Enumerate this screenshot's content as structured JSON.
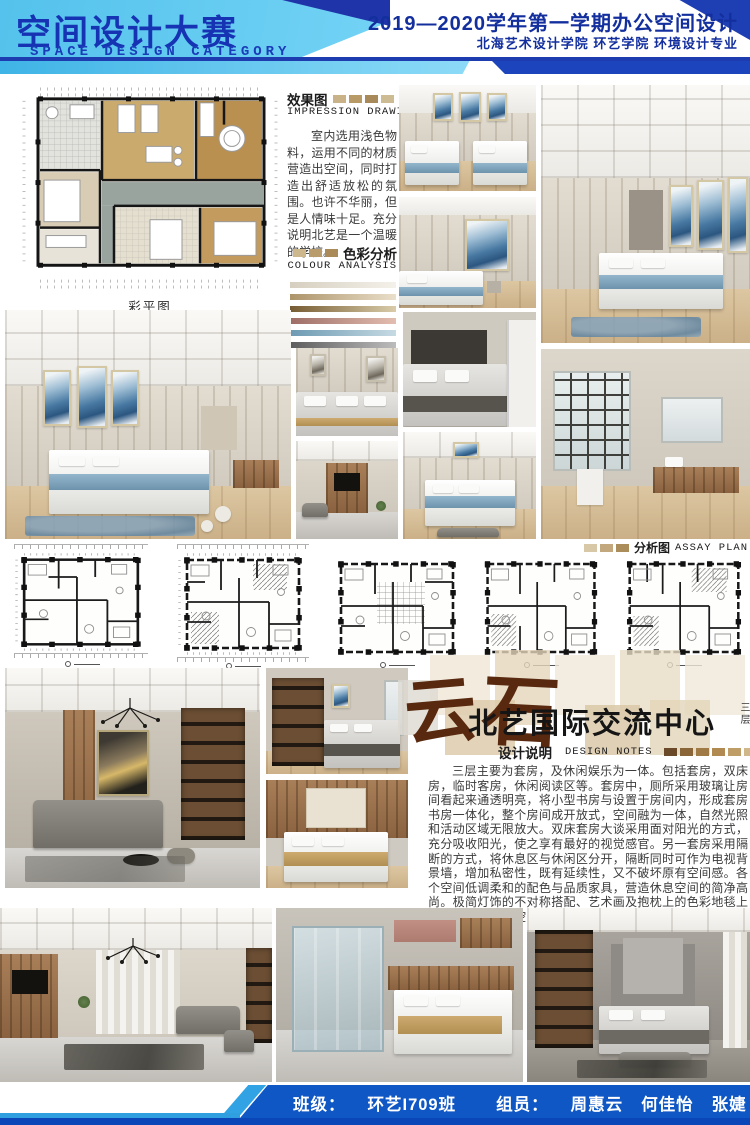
{
  "header": {
    "title_cn": "空间设计大赛",
    "title_en": "SPACE DESIGN CATEGORY",
    "course": "2019—2020学年第一学期办公空间设计",
    "school": "北海艺术设计学院  环艺学院  环境设计专业"
  },
  "impression": {
    "label_cn": "效果图",
    "label_en": "IMPRESSION DRAWING",
    "body": "室内选用浅色物料，运用不同的材质营造出空间，同时打造出舒适放松的氛围。也许不华丽，但是人情味十足。充分说明北艺是一个温暖的学校。",
    "strip": [
      "#c9b288",
      "#b79a66",
      "#a7895a",
      "#cdbb94"
    ]
  },
  "colour": {
    "label_cn": "色彩分析",
    "label_en": "COLOUR ANALYSIS",
    "strip": [
      "#cdb88e",
      "#b89c6b",
      "#a98a58"
    ],
    "bars": [
      {
        "from": "#d6cfc0",
        "to": "#f4f1ea"
      },
      {
        "from": "#ad946a",
        "to": "#eadfca"
      },
      {
        "from": "#765c33",
        "to": "#d9cca9"
      },
      {
        "from": "#9e6e66",
        "to": "#e3bdb0"
      },
      {
        "from": "#6d9ab2",
        "to": "#c6dae3"
      },
      {
        "from": "#5d5d5d",
        "to": "#bcbcbc"
      }
    ]
  },
  "plan": {
    "caption": "彩平图"
  },
  "assay": {
    "label_cn": "分析图",
    "label_en": "ASSAY PLAN",
    "strip": [
      "#d8c8a8",
      "#c2a87c",
      "#ab8d5b"
    ]
  },
  "brand": {
    "logo_chars": [
      "云",
      "石"
    ],
    "name": "北艺国际交流中心",
    "floor": "三层"
  },
  "notes": {
    "label_cn": "设计说明",
    "label_en": "DESIGN NOTES",
    "strip": [
      "#6b4a2a",
      "#8a6537",
      "#a07a45",
      "#b08a50",
      "#bf9d66",
      "#cfb78a",
      "#e0d0ac"
    ],
    "body": "三层主要为套房，及休闲娱乐为一体。包括套房，双床房，临时客房，休闲阅读区等。套房中，厕所采用玻璃让房间看起来通透明亮，将小型书房与设置于房间内，形成套房书房一体化，整个房间成开放式，空间融为一体，自然光照和活动区域无限放大。双床套房大谈采用面对阳光的方式，充分吸收阳光，使之享有最好的视觉感官。另一套房采用隔断的方式，将休息区与休闲区分开，隔断同时可作为电视背景墙，增加私密性，既有延续性，又不破坏原有空间感。各个空间低调柔和的配色与品质家具，营造休息空间的简净高尚。极简灯饰的不对称搭配、艺术画及抱枕上的色彩地毯上的纹样，打破了空间的单调感，彰显室内别具一格的审美格调。"
  },
  "footer": {
    "class_label": "班级：",
    "class_value": "环艺I709班",
    "members_label": "组员：",
    "members": [
      "周惠云",
      "何佳怡",
      "张婕"
    ]
  },
  "colors": {
    "header_cyan": "#5ac6ee",
    "header_navy": "#1b3ab2",
    "title_blue": "#1535ae",
    "footer_blue": "#0f55c4",
    "accent_blue": "#35a8e8",
    "logo_brown": "#58290f"
  }
}
